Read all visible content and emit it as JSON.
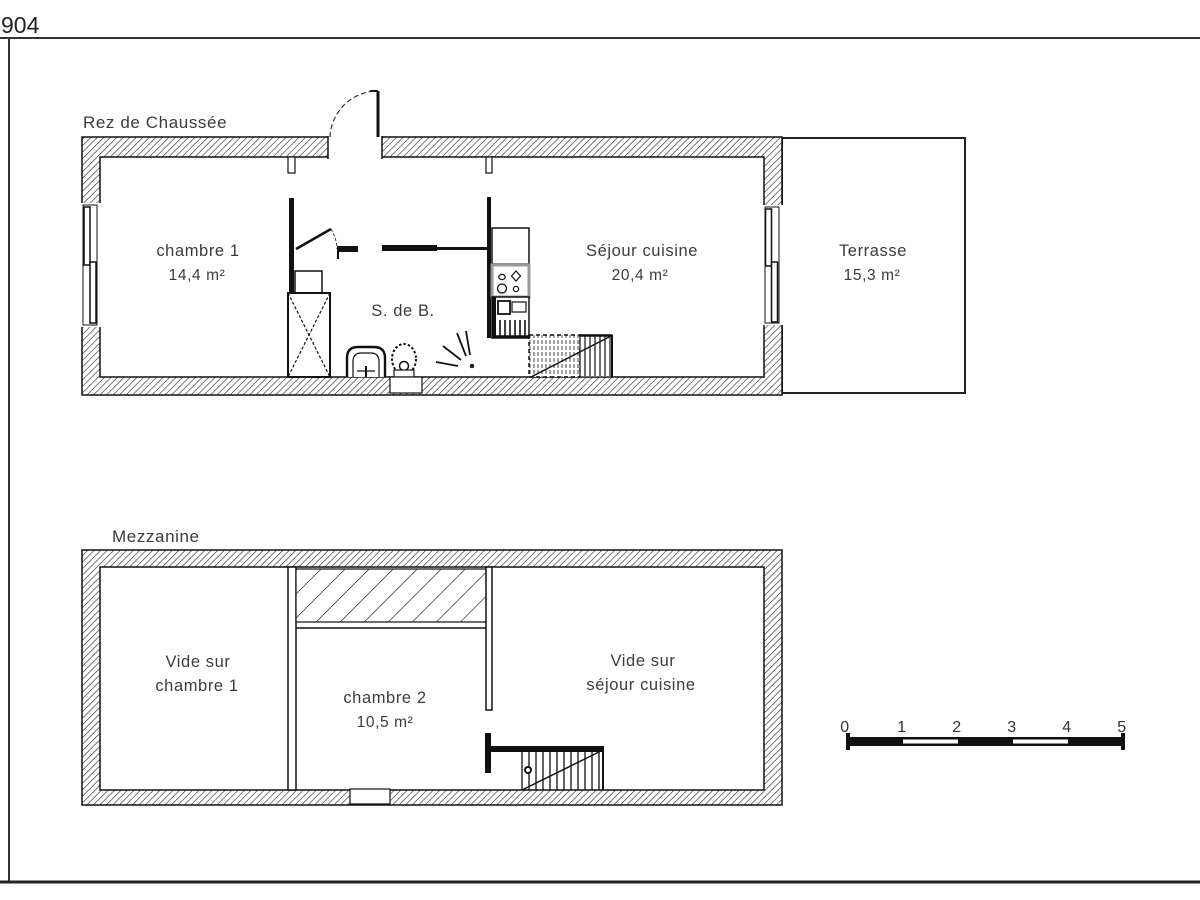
{
  "sheet": {
    "number": "904"
  },
  "ground_floor": {
    "title": "Rez de Chaussée",
    "chambre1": {
      "name": "chambre 1",
      "area": "14,4 m²"
    },
    "sdb": {
      "name": "S. de B."
    },
    "sejour": {
      "name": "Séjour cuisine",
      "area": "20,4 m²"
    },
    "terrasse": {
      "name": "Terrasse",
      "area": "15,3 m²"
    }
  },
  "mezzanine": {
    "title": "Mezzanine",
    "vide_chambre1": {
      "line1": "Vide sur",
      "line2": "chambre 1"
    },
    "chambre2": {
      "name": "chambre 2",
      "area": "10,5 m²"
    },
    "vide_sejour": {
      "line1": "Vide sur",
      "line2": "séjour cuisine"
    }
  },
  "scale_bar": {
    "ticks": [
      "0",
      "1",
      "2",
      "3",
      "4",
      "5"
    ]
  }
}
